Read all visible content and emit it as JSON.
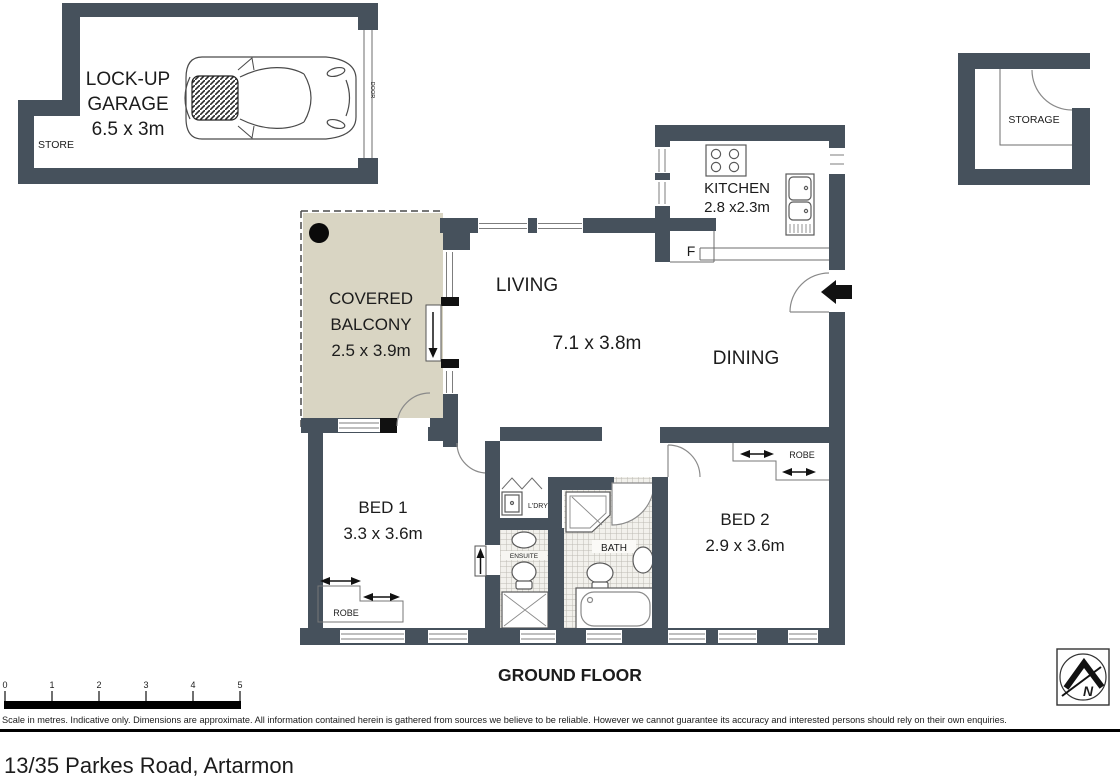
{
  "colors": {
    "wall": "#46515c",
    "balcony": "#d9d5c3",
    "accent_black": "#111111"
  },
  "plan": {
    "garage": {
      "line1": "LOCK-UP",
      "line2": "GARAGE",
      "dims": "6.5 x 3m",
      "store": "STORE",
      "door": "DOOR"
    },
    "storage": {
      "label": "STORAGE"
    },
    "kitchen": {
      "label": "KITCHEN",
      "dims": "2.8 x2.3m",
      "fridge": "F"
    },
    "living": {
      "label": "LIVING",
      "dims": "7.1 x 3.8m"
    },
    "dining": {
      "label": "DINING"
    },
    "balcony": {
      "line1": "COVERED",
      "line2": "BALCONY",
      "dims": "2.5 x 3.9m"
    },
    "bed1": {
      "label": "BED 1",
      "dims": "3.3 x 3.6m",
      "robe": "ROBE"
    },
    "bed2": {
      "label": "BED 2",
      "dims": "2.9 x 3.6m",
      "robe": "ROBE"
    },
    "bath": {
      "label": "BATH"
    },
    "laundry": {
      "label": "L'DRY"
    },
    "ensuite": {
      "label": "ENSUITE"
    }
  },
  "footer": {
    "floor_title": "GROUND FLOOR",
    "scale_labels": [
      "0",
      "1",
      "2",
      "3",
      "4",
      "5"
    ],
    "disclaimer": "Scale in metres. Indicative only. Dimensions are approximate. All information contained herein is gathered from sources we believe to be reliable. However we cannot guarantee its accuracy and interested persons should rely on their own enquiries.",
    "north": "N"
  },
  "address": "13/35 Parkes Road, Artarmon"
}
